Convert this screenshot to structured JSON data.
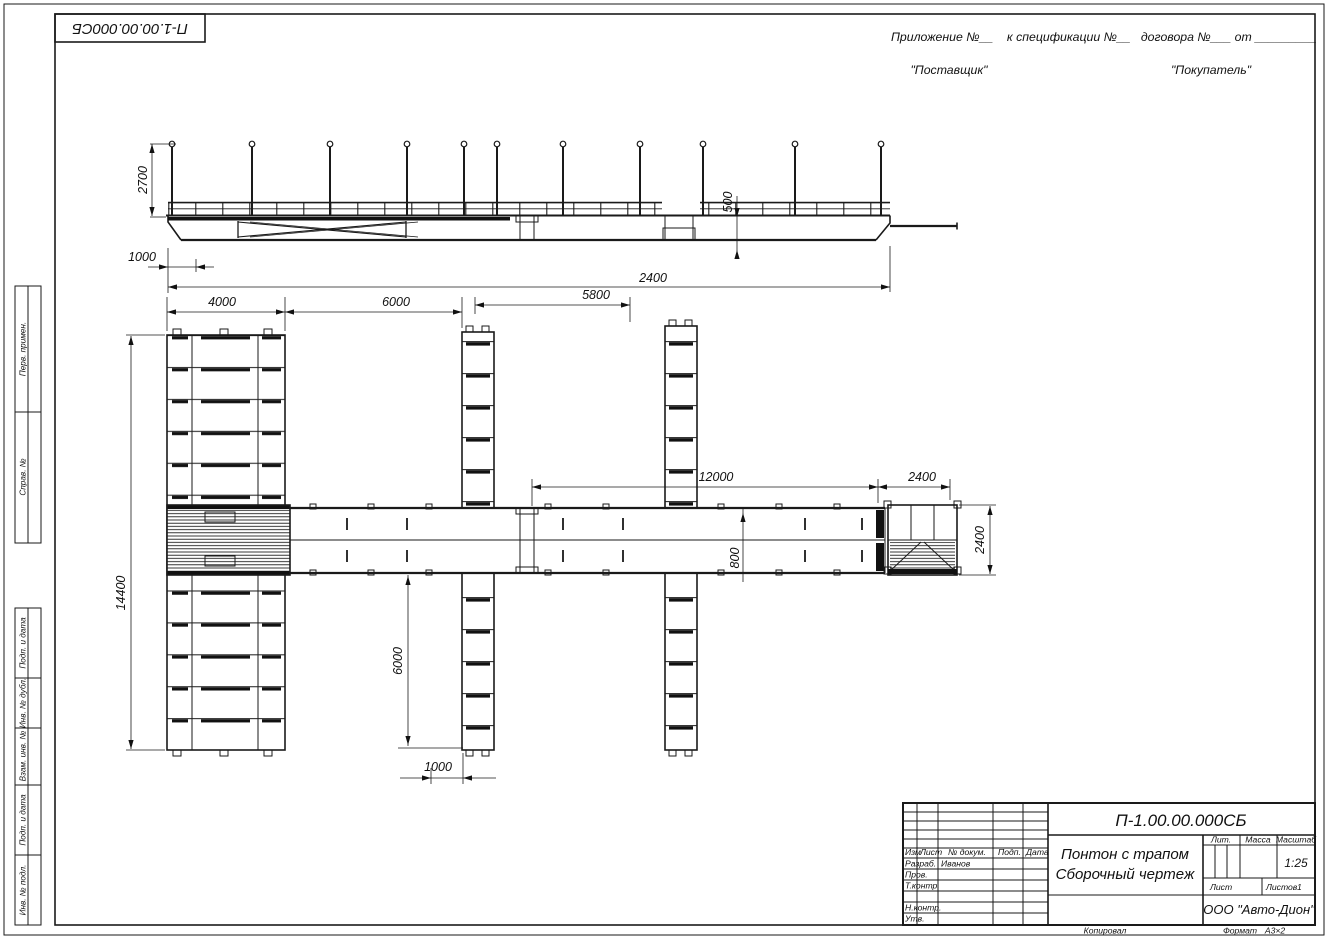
{
  "corner_stamp": {
    "designation_mirrored": "П-1.00.00.000СБ"
  },
  "header": {
    "annex_line": "Приложение №__    к спецификации №__   договора №___ от _________",
    "supplier": "\"Поставщик\"",
    "buyer": "\"Покупатель\""
  },
  "frame_left": {
    "labels": [
      "Перв. примен.",
      "Справ. №",
      "Подп. и дата",
      "Инв. № дубл.",
      "Взам. инв. №",
      "Подп. и дата",
      "Инв. № подл."
    ]
  },
  "dimensions": {
    "el_height": "2700",
    "el_offset": "1000",
    "el_length": "2400",
    "el_freeboard": "500",
    "top1": "4000",
    "top2": "6000",
    "top3": "5800",
    "mid1": "12000",
    "mid2": "2400",
    "left_v": "14400",
    "walk": "800",
    "bot_v": "6000",
    "bot_h": "1000",
    "right_v": "2400"
  },
  "title_block": {
    "designation": "П-1.00.00.000СБ",
    "doc_name_line1": "Понтон с трапом",
    "doc_name_line2": "Сборочный чертеж",
    "cols": {
      "izm": "Изм",
      "list": "Лист",
      "n_doc": "№ докум.",
      "podp": "Подп.",
      "data": "Дата"
    },
    "rows": {
      "razrab": "Разраб.",
      "razrab_name": "Иванов",
      "prov": "Пров.",
      "t_kontr": "Т.контр.",
      "n_kontr": "Н.контр.",
      "utv": "Утв."
    },
    "lit_label": "Лит.",
    "massa_label": "Масса",
    "masshtab_label": "Масштаб",
    "scale": "1:25",
    "list_label": "Лист",
    "listov_label": "Листов",
    "listov_value": "1",
    "company": "ООО \"Авто-Дион\"",
    "kopiroval": "Копировал",
    "format_label": "Формат",
    "format_value": "А3×2"
  }
}
